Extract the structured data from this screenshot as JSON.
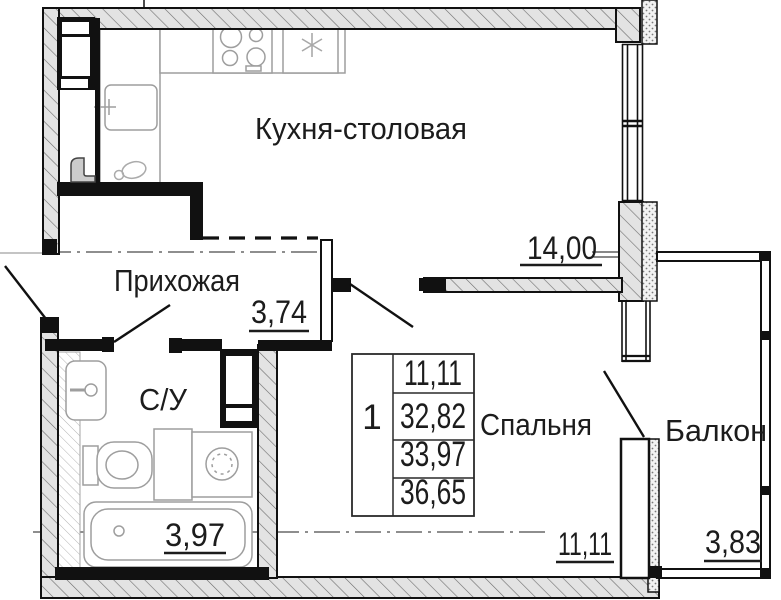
{
  "plan": {
    "rooms": {
      "kitchen": {
        "name": "Кухня-столовая",
        "area": "14,00"
      },
      "hallway": {
        "name": "Прихожая",
        "area": "3,74"
      },
      "bathroom": {
        "name": "С/У",
        "area": "3,97"
      },
      "bedroom": {
        "name": "Спальня",
        "area": "11,11"
      },
      "balcony": {
        "name": "Балкон",
        "area": "3,83"
      }
    },
    "summary": {
      "rooms_count": "1",
      "values": [
        "11,11",
        "32,82",
        "33,97",
        "36,65"
      ]
    },
    "colors": {
      "line": "#1c1c1c",
      "wall_fill": "#e3e3e3",
      "fixture": "#9e9e9e"
    }
  }
}
